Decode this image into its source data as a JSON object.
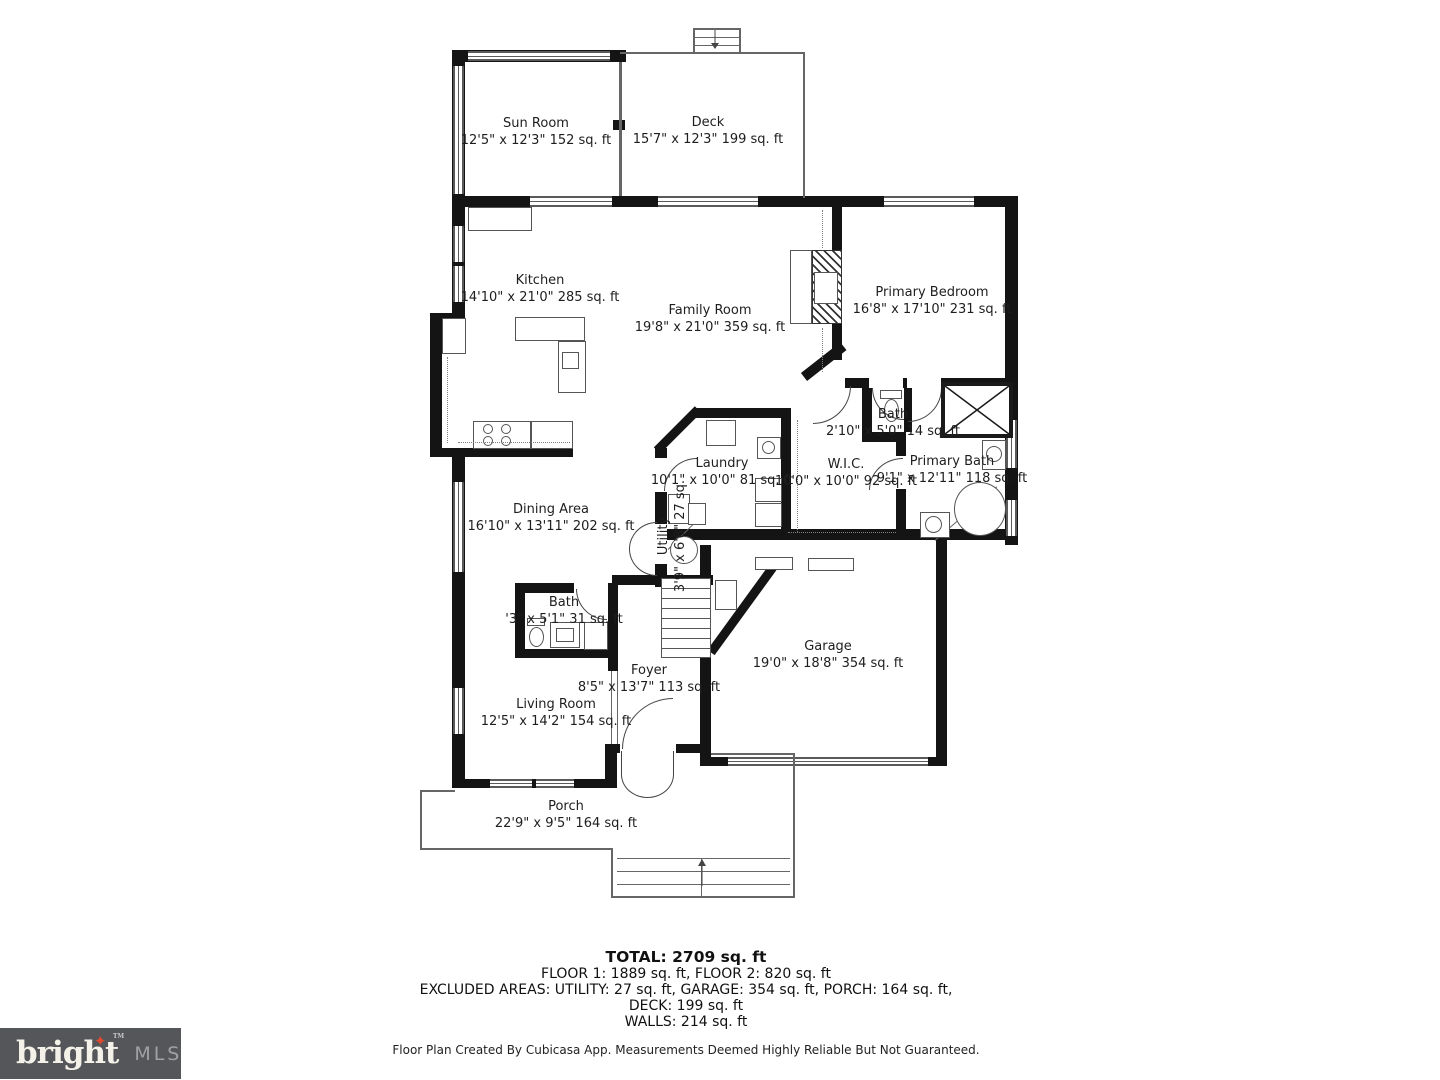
{
  "rooms": {
    "sun_room": {
      "name": "Sun Room",
      "dims": "12'5\" x 12'3\" 152 sq. ft"
    },
    "deck": {
      "name": "Deck",
      "dims": "15'7\" x 12'3\" 199 sq. ft"
    },
    "kitchen": {
      "name": "Kitchen",
      "dims": "14'10\" x 21'0\" 285 sq. ft"
    },
    "family_room": {
      "name": "Family Room",
      "dims": "19'8\" x 21'0\" 359 sq. ft"
    },
    "primary_bedroom": {
      "name": "Primary Bedroom",
      "dims": "16'8\" x 17'10\" 231 sq. ft"
    },
    "bath_small": {
      "name": "Bath",
      "dims": "2'10\" x 5'0\" 14 sq. ft"
    },
    "laundry": {
      "name": "Laundry",
      "dims": "10'1\" x 10'0\" 81 sq. ft"
    },
    "wic": {
      "name": "W.I.C.",
      "dims": "10'0\" x 10'0\" 92 sq. ft"
    },
    "primary_bath": {
      "name": "Primary Bath",
      "dims": "9'1\" x 12'11\" 118 sq. ft"
    },
    "dining_area": {
      "name": "Dining Area",
      "dims": "16'10\" x 13'11\" 202 sq. ft"
    },
    "utility": {
      "name": "Utility",
      "dims": "3'9\" x 6'8\" 27 sq."
    },
    "bath_main": {
      "name": "Bath",
      "dims": "'3\" x 5'1\" 31 sq. ft"
    },
    "foyer": {
      "name": "Foyer",
      "dims": "8'5\" x 13'7\" 113 sq. ft"
    },
    "garage": {
      "name": "Garage",
      "dims": "19'0\" x 18'8\" 354 sq. ft"
    },
    "living_room": {
      "name": "Living Room",
      "dims": "12'5\" x 14'2\" 154 sq. ft"
    },
    "porch": {
      "name": "Porch",
      "dims": "22'9\" x 9'5\" 164 sq. ft"
    }
  },
  "summary": {
    "total": "TOTAL: 2709 sq. ft",
    "floors": "FLOOR 1: 1889 sq. ft, FLOOR 2: 820 sq. ft",
    "excluded": "EXCLUDED AREAS: UTILITY: 27 sq. ft, GARAGE: 354 sq. ft, PORCH: 164 sq. ft,",
    "deck": "DECK: 199 sq. ft",
    "walls": "WALLS: 214 sq. ft"
  },
  "disclaimer": "Floor Plan Created By Cubicasa App. Measurements Deemed Highly Reliable But Not Guaranteed.",
  "logo": {
    "brand": "bright",
    "tm": "TM",
    "suffix": "MLS",
    "colors": {
      "background": "#54565a",
      "brand_text": "#f4f1e8",
      "suffix_text": "#9fa1a4",
      "star": "#e1492f"
    }
  }
}
